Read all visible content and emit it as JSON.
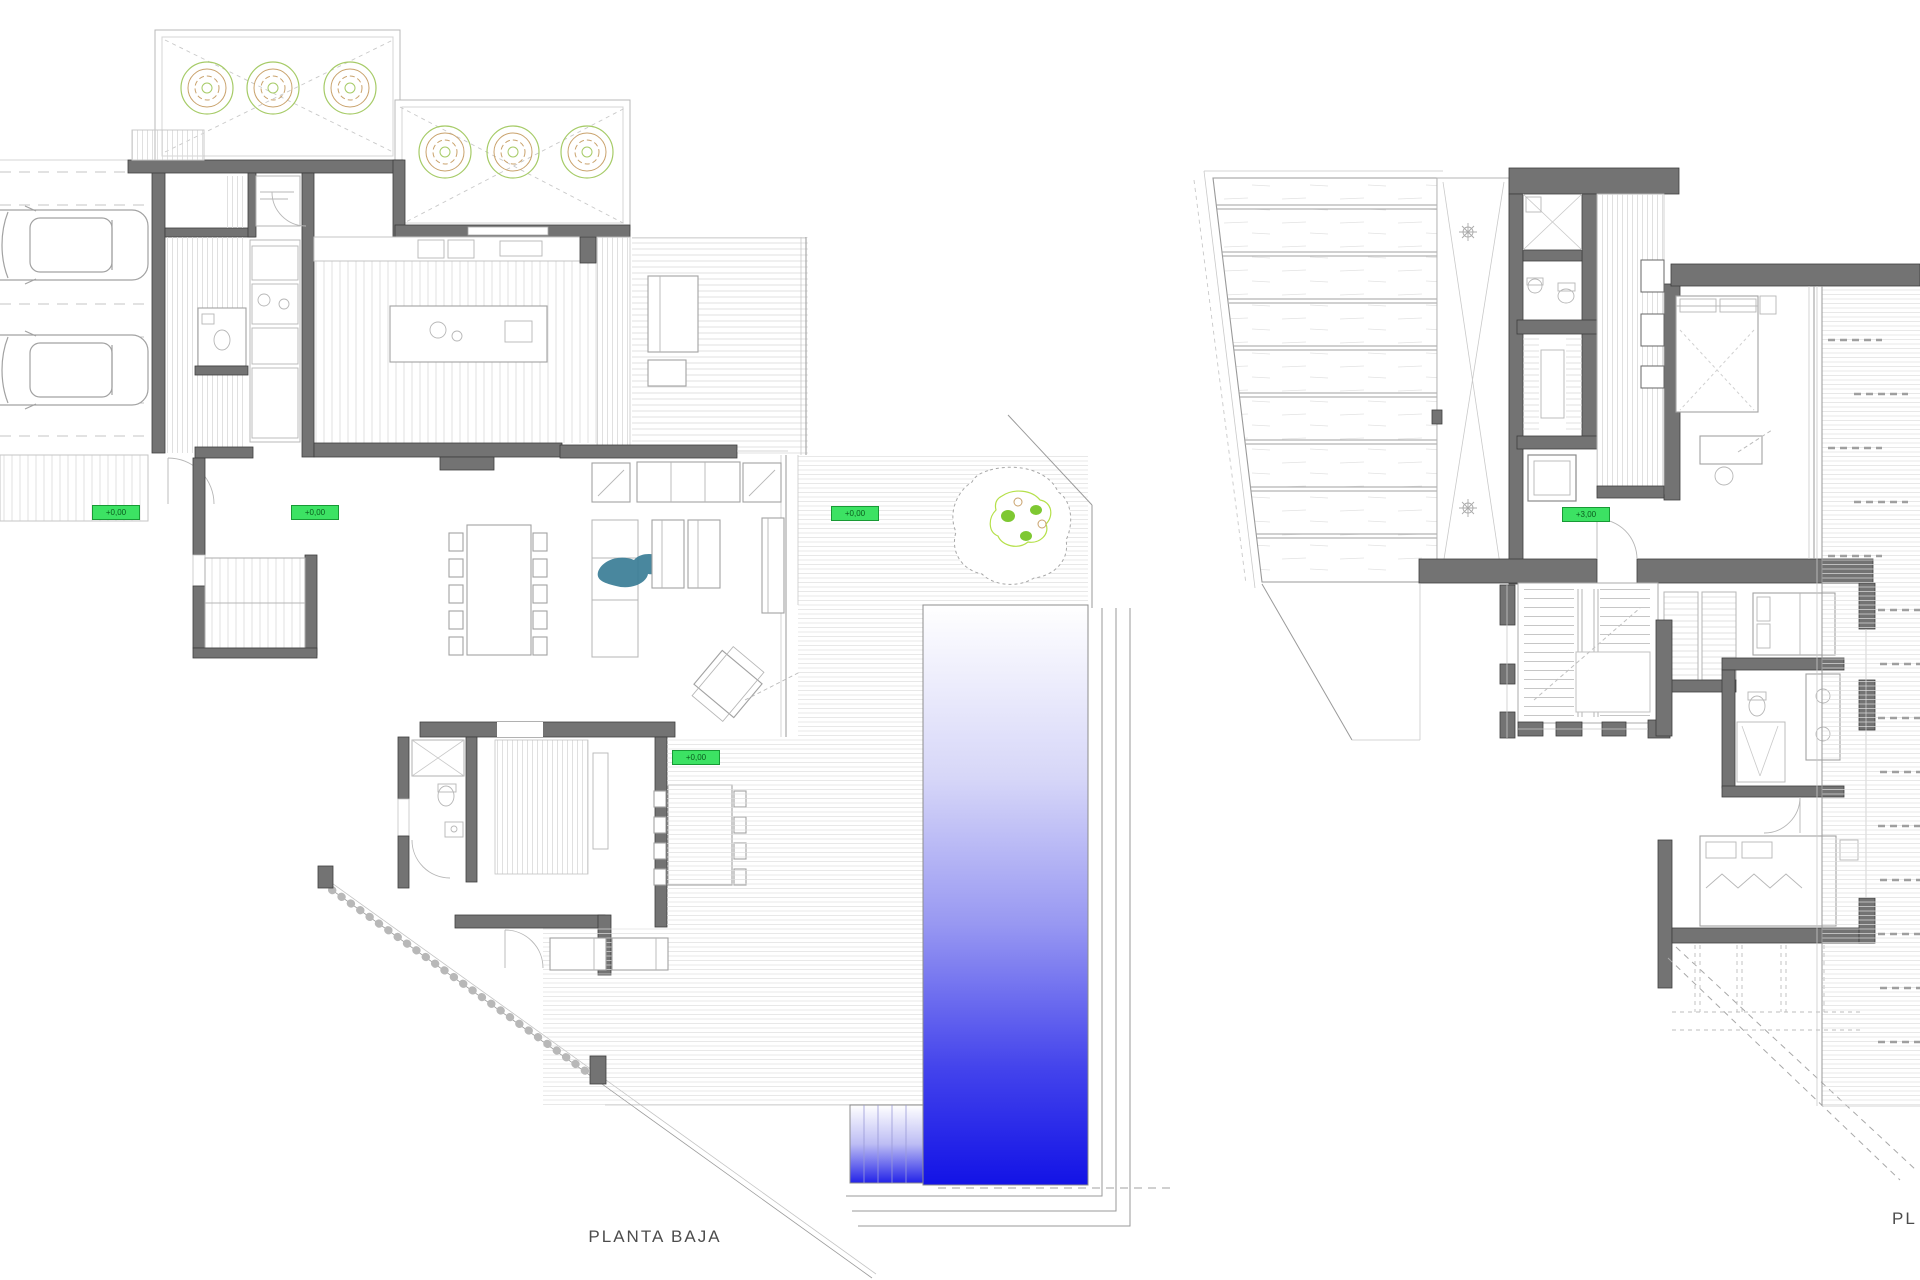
{
  "page": {
    "background_color": "#ffffff",
    "description": "Architectural sheet with two villa floor plans, pool on ground floor"
  },
  "plans": {
    "ground_floor": {
      "title": "PLANTA BAJA",
      "elevation_markers": [
        {
          "location": "driveway",
          "text": "+0,00"
        },
        {
          "location": "entry-hall",
          "text": "+0,00"
        },
        {
          "location": "pool-deck",
          "text": "+0,00"
        },
        {
          "location": "family-terrace",
          "text": "+0,00"
        }
      ]
    },
    "first_floor": {
      "title_partial": "PL",
      "elevation_markers": [
        {
          "location": "landing",
          "text": "+3,00"
        }
      ]
    }
  },
  "colors": {
    "wall_fill": "#737373",
    "marker_green": "#3ce263",
    "pool_blue_deep": "#1313e6",
    "tree_green": "#a6cb67",
    "tree_tan": "#c9a26c",
    "rug_teal": "#3a7d96"
  }
}
